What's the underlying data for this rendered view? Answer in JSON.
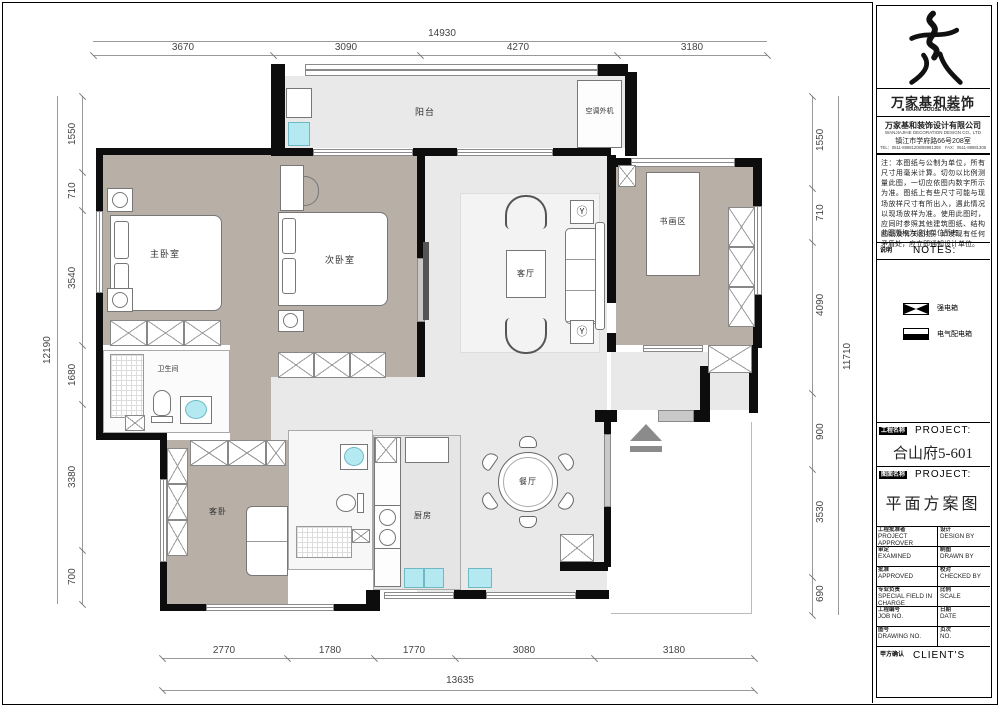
{
  "plan": {
    "rooms": {
      "balcony": "阳台",
      "ac": "空调外机",
      "master": "主卧室",
      "second": "次卧室",
      "living": "客厅",
      "study": "书画区",
      "bath": "卫生间",
      "guest": "客卧",
      "kitchen": "厨房",
      "dining": "餐厅"
    },
    "dims_top": {
      "total": "14930",
      "seg": [
        "3670",
        "3090",
        "4270",
        "3180"
      ]
    },
    "dims_bottom": {
      "total": "13635",
      "seg": [
        "2770",
        "1780",
        "1770",
        "3080",
        "3180"
      ]
    },
    "dims_left": {
      "total": "12190",
      "seg": [
        "1550",
        "710",
        "3540",
        "1680",
        "3380",
        "700"
      ]
    },
    "dims_right": {
      "total": "11710",
      "seg": [
        "1550",
        "710",
        "4090",
        "900",
        "3530",
        "690"
      ]
    }
  },
  "tb": {
    "brand": {
      "name": "万家基和装饰",
      "tagline": "■ WARM GOOSE HOUSE ■"
    },
    "company": {
      "l1": "万家基和装饰设计有限公司",
      "l2": "WANJIAJIHE DECORATION DESIGN CO., LTD",
      "l3": "镇江市学府路66号208室",
      "l4": "TEL：0511-88981208/88981308　FAX：0511-88981308"
    },
    "notes": {
      "text": "注：本图纸与公制为单位，所有尺寸用毫米计算。切勿以比例测量此图，一切应依图内数字所示为准。图纸上有些尺寸可能与现场放样尺寸有所出入，遇此情况以现场放样为准。使用此图时，应同时参照其他建筑图纸、结构图纸及有关图纸。如发现有任何矛盾处，应立即通知设计单位。",
      "copyright": "此图版权为设计单位所有。"
    },
    "notes_header": {
      "cn": "说明",
      "en": "NOTES:"
    },
    "legend": [
      {
        "label": "强电箱"
      },
      {
        "label": "电气配电箱"
      }
    ],
    "project": {
      "cn": "工程名称",
      "en": "PROJECT:",
      "value": "合山府5-601"
    },
    "drawing": {
      "cn": "图面名称",
      "en": "PROJECT:",
      "value": "平面方案图"
    },
    "table": [
      {
        "lc": "工程批准者",
        "le": "PROJECT APPROVER",
        "rc": "设计",
        "re": "DESIGN BY"
      },
      {
        "lc": "审定",
        "le": "EXAMINED",
        "rc": "制图",
        "re": "DRAWN BY"
      },
      {
        "lc": "批准",
        "le": "APPROVED",
        "rc": "校对",
        "re": "CHECKED BY"
      },
      {
        "lc": "专业负责",
        "le": "SPECIAL FIELD IN CHARGE",
        "rc": "比例",
        "re": "SCALE"
      },
      {
        "lc": "工程编号",
        "le": "JOB NO.",
        "rc": "日期",
        "re": "DATE"
      },
      {
        "lc": "图号",
        "le": "DRAWING NO.",
        "rc": "页次",
        "re": "NO."
      }
    ],
    "client": {
      "cn": "甲方确认",
      "en": "CLIENT'S"
    }
  }
}
